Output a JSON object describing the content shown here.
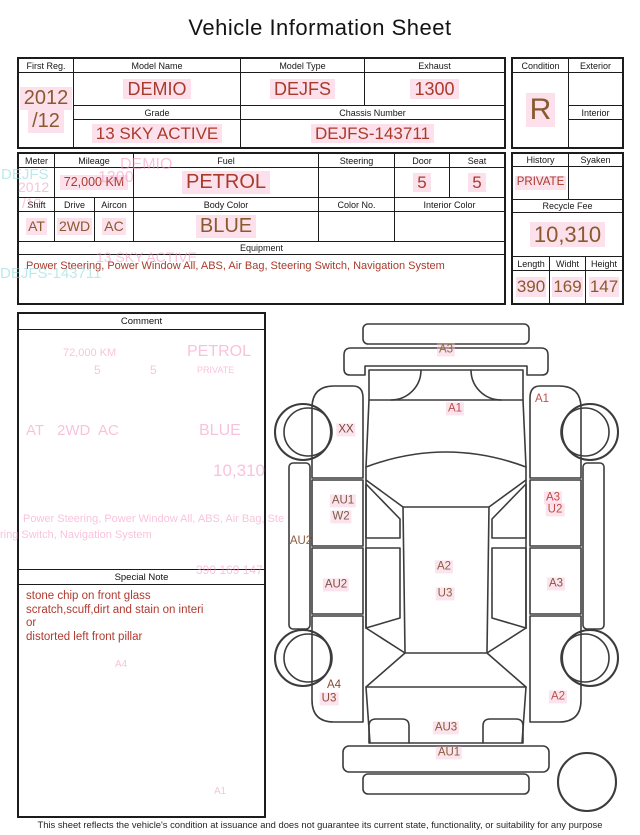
{
  "title": "Vehicle Information Sheet",
  "footer": "This sheet reflects the vehicle's condition at issuance and does not guarantee its current state, functionality, or suitability for any purpose",
  "colors": {
    "value_red": "#a93b2c",
    "value_brown": "#8a5a2e",
    "note_red": "#b03a30",
    "highlight_pink": "#f9c3dc",
    "ghost_pink": "#f592bf",
    "ghost_teal": "#86d8da",
    "line": "#1c1c1c"
  },
  "table1": {
    "first_reg": {
      "label": "First Reg.",
      "line1": "2012",
      "line2": "/12"
    },
    "model_name": {
      "label": "Model Name",
      "value": "DEMIO"
    },
    "model_type": {
      "label": "Model Type",
      "value": "DEJFS"
    },
    "exhaust": {
      "label": "Exhaust",
      "value": "1300"
    },
    "grade": {
      "label": "Grade",
      "value": "13 SKY ACTIVE"
    },
    "chassis_number": {
      "label": "Chassis Number",
      "value": "DEJFS-143711"
    },
    "condition": {
      "label": "Condition",
      "value": "R"
    },
    "exterior": {
      "label": "Exterior",
      "value": ""
    },
    "interior": {
      "label": "Interior",
      "value": ""
    }
  },
  "table2": {
    "meter": {
      "label": "Meter",
      "value": ""
    },
    "mileage": {
      "label": "Mileage",
      "value": "72,000 KM"
    },
    "fuel": {
      "label": "Fuel",
      "value": "PETROL"
    },
    "steering": {
      "label": "Steering",
      "value": ""
    },
    "door": {
      "label": "Door",
      "value": "5"
    },
    "seat": {
      "label": "Seat",
      "value": "5"
    },
    "shift": {
      "label": "Shift",
      "value": "AT"
    },
    "drive": {
      "label": "Drive",
      "value": "2WD"
    },
    "aircon": {
      "label": "Aircon",
      "value": "AC"
    },
    "body_color": {
      "label": "Body Color",
      "value": "BLUE"
    },
    "color_no": {
      "label": "Color No.",
      "value": ""
    },
    "interior_color": {
      "label": "Interior Color",
      "value": ""
    },
    "history": {
      "label": "History",
      "value": "PRIVATE"
    },
    "syaken": {
      "label": "Syaken",
      "value": ""
    },
    "recycle_fee": {
      "label": "Recycle Fee",
      "value": "10,310"
    },
    "equipment": {
      "label": "Equipment",
      "value": "Power Steering, Power Window  All, ABS, Air Bag, Steering Switch, Navigation System"
    },
    "length": {
      "label": "Length",
      "value": "390"
    },
    "widht": {
      "label": "Widht",
      "value": "169"
    },
    "height": {
      "label": "Height",
      "value": "147"
    }
  },
  "comment": {
    "label": "Comment"
  },
  "special_note": {
    "label": "Special Note",
    "lines": [
      "stone chip on front glass",
      "scratch,scuff,dirt and stain on interi",
      "or",
      "distorted left front pillar"
    ]
  },
  "diagram": {
    "labels": [
      {
        "text": "A3",
        "x": 181,
        "y": 40,
        "color": "#8f6b33",
        "hl": true
      },
      {
        "text": "A1",
        "x": 190,
        "y": 99,
        "color": "#bb5047",
        "hl": true
      },
      {
        "text": "A1",
        "x": 277,
        "y": 89,
        "color": "#bb5047",
        "hl": false
      },
      {
        "text": "XX",
        "x": 81,
        "y": 120,
        "color": "#7a4632",
        "hl": true
      },
      {
        "text": "AU1",
        "x": 78,
        "y": 191,
        "color": "#7d5a46",
        "hl": true
      },
      {
        "text": "W2",
        "x": 76,
        "y": 207,
        "color": "#7d5a46",
        "hl": true
      },
      {
        "text": "A3",
        "x": 288,
        "y": 188,
        "color": "#c24b42",
        "hl": true
      },
      {
        "text": "U2",
        "x": 290,
        "y": 200,
        "color": "#c24b42",
        "hl": true
      },
      {
        "text": "AU2",
        "x": 36,
        "y": 231,
        "color": "#8a5c40",
        "hl": false
      },
      {
        "text": "AU2",
        "x": 71,
        "y": 275,
        "color": "#7d5440",
        "hl": true
      },
      {
        "text": "A2",
        "x": 179,
        "y": 257,
        "color": "#8a5e40",
        "hl": true
      },
      {
        "text": "U3",
        "x": 180,
        "y": 284,
        "color": "#8a5e40",
        "hl": true
      },
      {
        "text": "A3",
        "x": 291,
        "y": 274,
        "color": "#8a5340",
        "hl": true
      },
      {
        "text": "A4",
        "x": 69,
        "y": 375,
        "color": "#8a4a35",
        "hl": false
      },
      {
        "text": "U3",
        "x": 64,
        "y": 389,
        "color": "#8a4a35",
        "hl": true
      },
      {
        "text": "A2",
        "x": 293,
        "y": 387,
        "color": "#bb5047",
        "hl": true
      },
      {
        "text": "AU3",
        "x": 181,
        "y": 418,
        "color": "#8a5a35",
        "hl": true
      },
      {
        "text": "AU1",
        "x": 184,
        "y": 443,
        "color": "#8a5a35",
        "hl": true
      }
    ]
  },
  "ghosts": [
    {
      "text": "DEJFS",
      "x": 1,
      "y": 167,
      "size": 15,
      "color": "teal"
    },
    {
      "text": "DEMIO",
      "x": 120,
      "y": 157,
      "size": 16,
      "color": "pink"
    },
    {
      "text": "1300",
      "x": 98,
      "y": 170,
      "size": 16,
      "color": "pink"
    },
    {
      "text": "2012",
      "x": 18,
      "y": 180,
      "size": 14,
      "color": "pink"
    },
    {
      "text": "/12",
      "x": 22,
      "y": 196,
      "size": 14,
      "color": "pink"
    },
    {
      "text": "13 SKY ACTIVE",
      "x": 96,
      "y": 250,
      "size": 14,
      "color": "pink"
    },
    {
      "text": "DEJFS-143711",
      "x": 0,
      "y": 266,
      "size": 15,
      "color": "teal"
    },
    {
      "text": "72,000 KM",
      "x": 63,
      "y": 348,
      "size": 11,
      "color": "pink"
    },
    {
      "text": "5",
      "x": 94,
      "y": 364,
      "size": 12,
      "color": "pink"
    },
    {
      "text": "5",
      "x": 150,
      "y": 364,
      "size": 12,
      "color": "pink"
    },
    {
      "text": "PETROL",
      "x": 187,
      "y": 344,
      "size": 16,
      "color": "pink"
    },
    {
      "text": "PRIVATE",
      "x": 197,
      "y": 366,
      "size": 9,
      "color": "pink"
    },
    {
      "text": "AT",
      "x": 26,
      "y": 423,
      "size": 15,
      "color": "pink"
    },
    {
      "text": "2WD",
      "x": 57,
      "y": 423,
      "size": 15,
      "color": "pink"
    },
    {
      "text": "AC",
      "x": 98,
      "y": 423,
      "size": 15,
      "color": "pink"
    },
    {
      "text": "BLUE",
      "x": 199,
      "y": 423,
      "size": 16,
      "color": "pink"
    },
    {
      "text": "10,310",
      "x": 213,
      "y": 462,
      "size": 17,
      "color": "pink"
    },
    {
      "text": "Power Steering, Power Window All, ABS, Air Bag, Ste",
      "x": 23,
      "y": 514,
      "size": 11,
      "color": "pink"
    },
    {
      "text": "ring Switch, Navigation System",
      "x": 0,
      "y": 530,
      "size": 11,
      "color": "pink"
    },
    {
      "text": "390  169  147",
      "x": 196,
      "y": 564,
      "size": 12,
      "color": "pink"
    },
    {
      "text": "A4",
      "x": 115,
      "y": 660,
      "size": 10,
      "color": "pink"
    },
    {
      "text": "A1",
      "x": 214,
      "y": 787,
      "size": 10,
      "color": "pink"
    }
  ]
}
